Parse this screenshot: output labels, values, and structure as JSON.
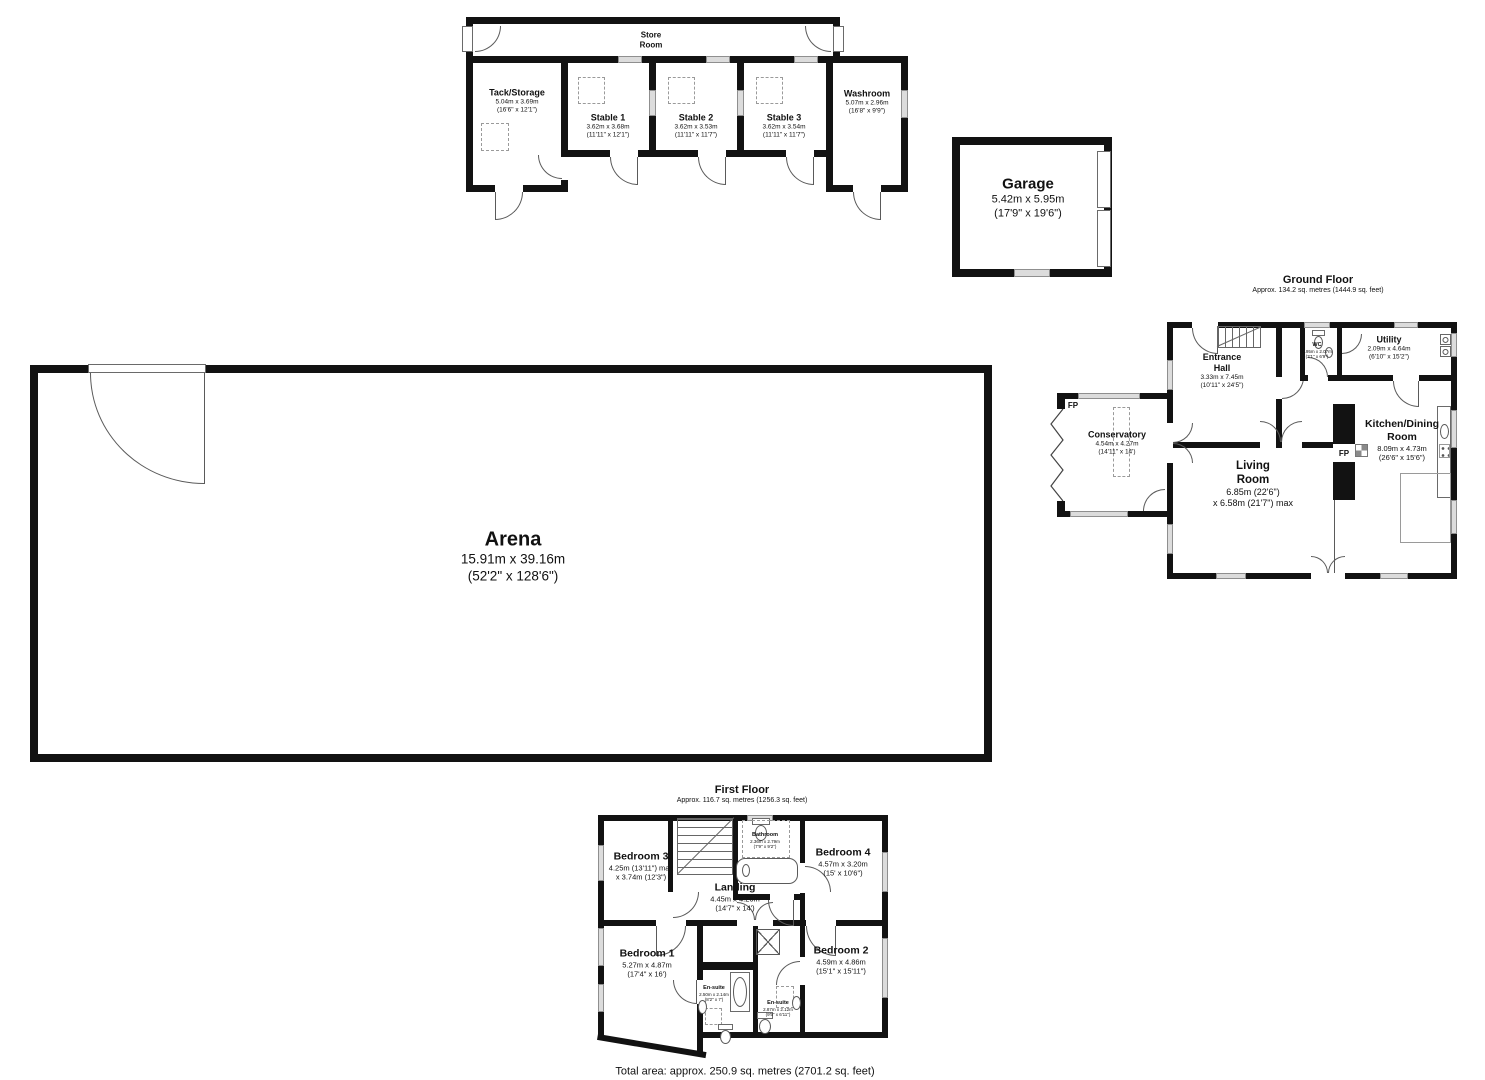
{
  "floors": {
    "ground": {
      "title": "Ground Floor",
      "subtitle": "Approx. 134.2 sq. metres (1444.9 sq. feet)"
    },
    "first": {
      "title": "First Floor",
      "subtitle": "Approx. 116.7 sq. metres (1256.3 sq. feet)"
    }
  },
  "footer": {
    "total_area": "Total area: approx. 250.9 sq. metres (2701.2 sq. feet)"
  },
  "fp_label": "FP",
  "rooms": {
    "store_room": {
      "name": "Store\nRoom"
    },
    "tack_storage": {
      "name": "Tack/Storage",
      "dims_m": "5.04m x 3.69m",
      "dims_ft": "(16'6\" x 12'1\")"
    },
    "stable1": {
      "name": "Stable 1",
      "dims_m": "3.62m x 3.68m",
      "dims_ft": "(11'11\" x 12'1\")"
    },
    "stable2": {
      "name": "Stable 2",
      "dims_m": "3.62m x 3.53m",
      "dims_ft": "(11'11\" x 11'7\")"
    },
    "stable3": {
      "name": "Stable 3",
      "dims_m": "3.62m x 3.54m",
      "dims_ft": "(11'11\" x 11'7\")"
    },
    "washroom": {
      "name": "Washroom",
      "dims_m": "5.07m x 2.96m",
      "dims_ft": "(16'8\" x 9'9\")"
    },
    "garage": {
      "name": "Garage",
      "dims_m": "5.42m x 5.95m",
      "dims_ft": "(17'9\" x 19'6\")"
    },
    "arena": {
      "name": "Arena",
      "dims_m": "15.91m x 39.16m",
      "dims_ft": "(52'2\" x 128'6\")"
    },
    "entrance_hall": {
      "name": "Entrance\nHall",
      "dims_m": "3.33m x 7.45m",
      "dims_ft": "(10'11\" x 24'5\")"
    },
    "wc": {
      "name": "WC",
      "dims_m": "0.95m x 2.07m",
      "dims_ft": "(3'1\" x 6'9\")"
    },
    "utility": {
      "name": "Utility",
      "dims_m": "2.09m x 4.64m",
      "dims_ft": "(6'10\" x 15'2\")"
    },
    "kitchen": {
      "name": "Kitchen/Dining\nRoom",
      "dims_m": "8.09m x 4.73m",
      "dims_ft": "(26'6\" x 15'6\")"
    },
    "living_room": {
      "name": "Living\nRoom",
      "dims_m": "6.85m (22'6\")",
      "dims_ft": "x 6.58m (21'7\") max"
    },
    "conservatory": {
      "name": "Conservatory",
      "dims_m": "4.54m x 4.27m",
      "dims_ft": "(14'11\" x 14')"
    },
    "bedroom1": {
      "name": "Bedroom 1",
      "dims_m": "5.27m x 4.87m",
      "dims_ft": "(17'4\" x 16')"
    },
    "bedroom2": {
      "name": "Bedroom 2",
      "dims_m": "4.59m x 4.86m",
      "dims_ft": "(15'1\" x 15'11\")"
    },
    "bedroom3": {
      "name": "Bedroom 3",
      "dims_m": "4.25m (13'11\") max",
      "dims_ft": "x 3.74m (12'3\")"
    },
    "bedroom4": {
      "name": "Bedroom 4",
      "dims_m": "4.57m x 3.20m",
      "dims_ft": "(15' x 10'6\")"
    },
    "landing": {
      "name": "Landing",
      "dims_m": "4.45m x 4.26m",
      "dims_ft": "(14'7\" x 14')"
    },
    "bathroom": {
      "name": "Bathroom",
      "dims_m": "2.36m x 2.79m",
      "dims_ft": "(7'9\" x 9'2\")"
    },
    "ensuite1": {
      "name": "En-suite",
      "dims_m": "2.50m x 2.14m",
      "dims_ft": "(8'2\" x 7')"
    },
    "ensuite2": {
      "name": "En-suite",
      "dims_m": "2.87m x 2.12m",
      "dims_ft": "(9'5\" x 6'11\")"
    }
  }
}
